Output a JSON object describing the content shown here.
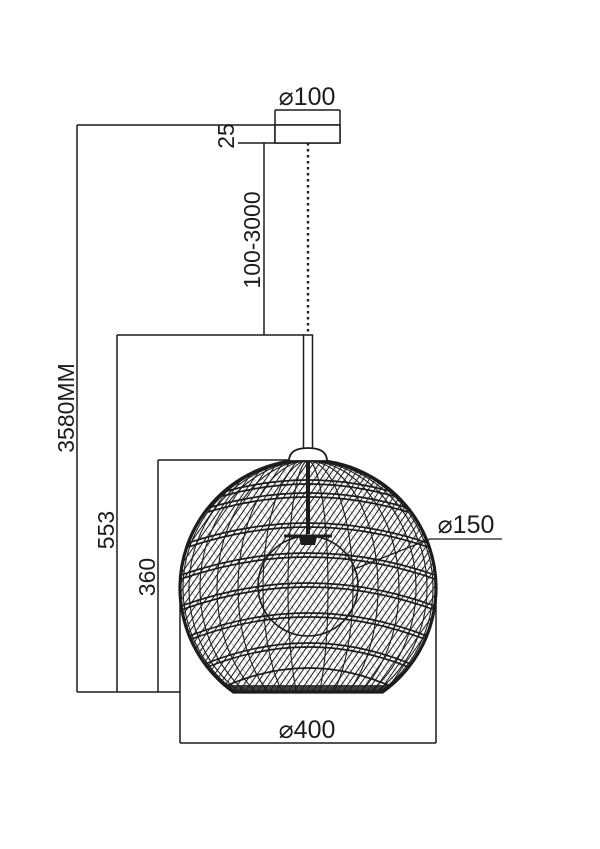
{
  "drawing": {
    "name": "Pendant lamp technical dimension drawing",
    "colors": {
      "line": "#1c1c1c",
      "background": "#ffffff"
    },
    "labels": {
      "canopy_diameter": "⌀100",
      "canopy_thickness": "25",
      "suspension_length": "100-3000",
      "overall_height": "3580MM",
      "fixture_drop": "553",
      "shade_height": "360",
      "bulb_diameter": "⌀150",
      "shade_diameter": "⌀400"
    }
  }
}
